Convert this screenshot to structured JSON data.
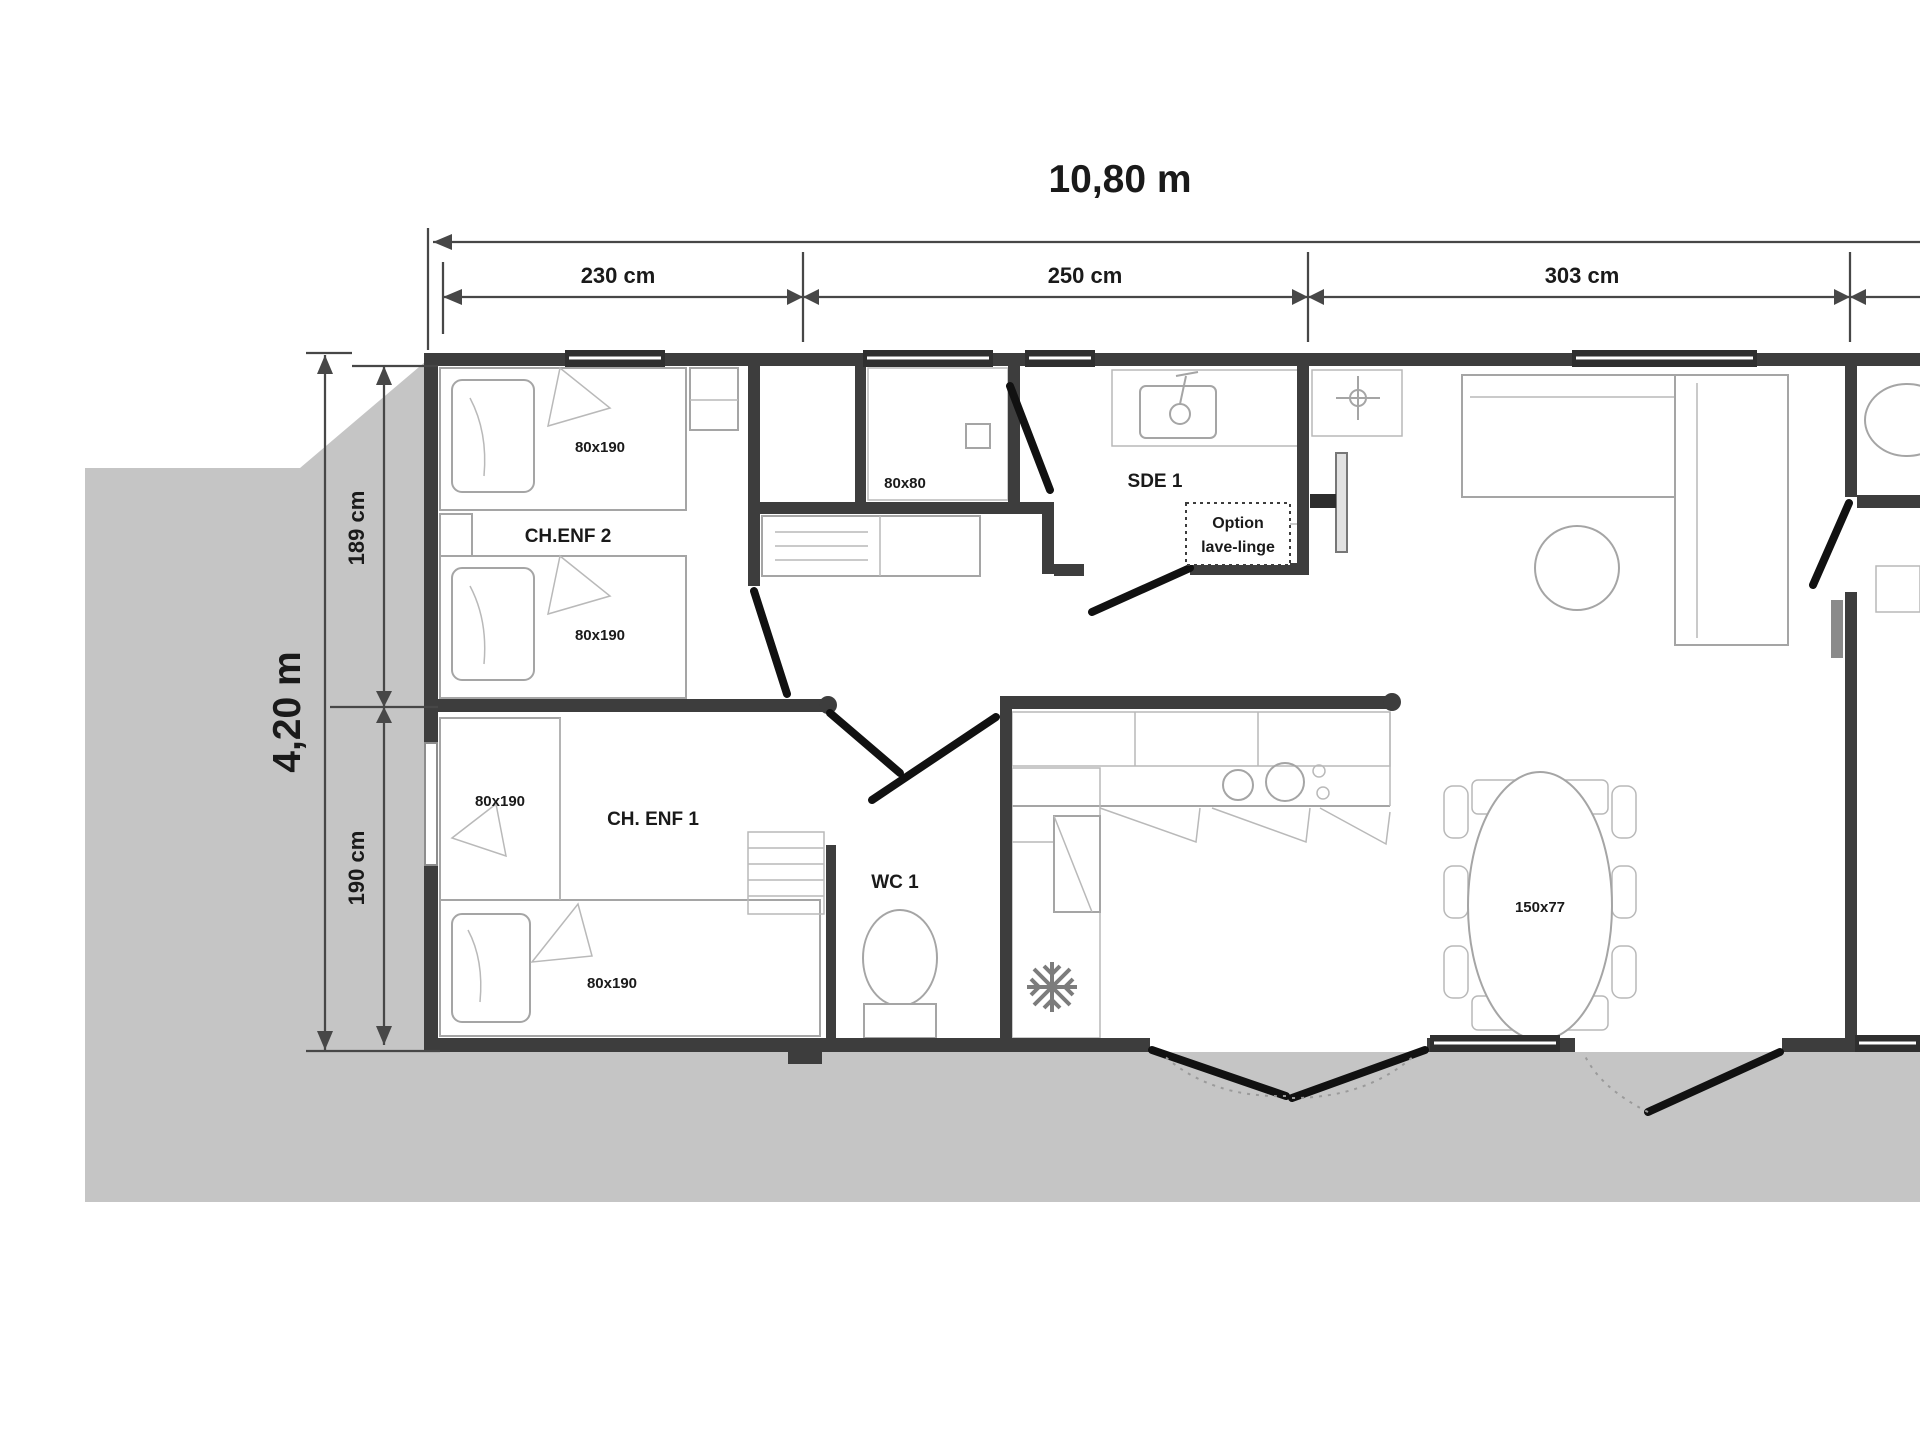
{
  "plan": {
    "dimensions": {
      "width_total": "10,80 m",
      "height_total": "4,20 m",
      "top_segments": [
        "230 cm",
        "250 cm",
        "303 cm"
      ],
      "left_segments": [
        "189 cm",
        "190 cm"
      ]
    },
    "rooms": {
      "bedroom2": {
        "name": "CH.ENF 2",
        "beds": [
          "80x190",
          "80x190"
        ]
      },
      "bedroom1": {
        "name": "CH. ENF 1",
        "beds": [
          "80x190",
          "80x190"
        ]
      },
      "shower": {
        "size": "80x80"
      },
      "bathroom1": {
        "name": "SDE 1",
        "option_line1": "Option",
        "option_line2": "lave-linge"
      },
      "wc1": {
        "name": "WC 1"
      },
      "dining": {
        "table_size": "150x77"
      }
    },
    "colors": {
      "backdrop": "#c5c5c5",
      "wall": "#3d3d3d",
      "furniture": "#a5a5a5",
      "door": "#111111",
      "dimension": "#474747",
      "text": "#1a1a1a"
    }
  }
}
